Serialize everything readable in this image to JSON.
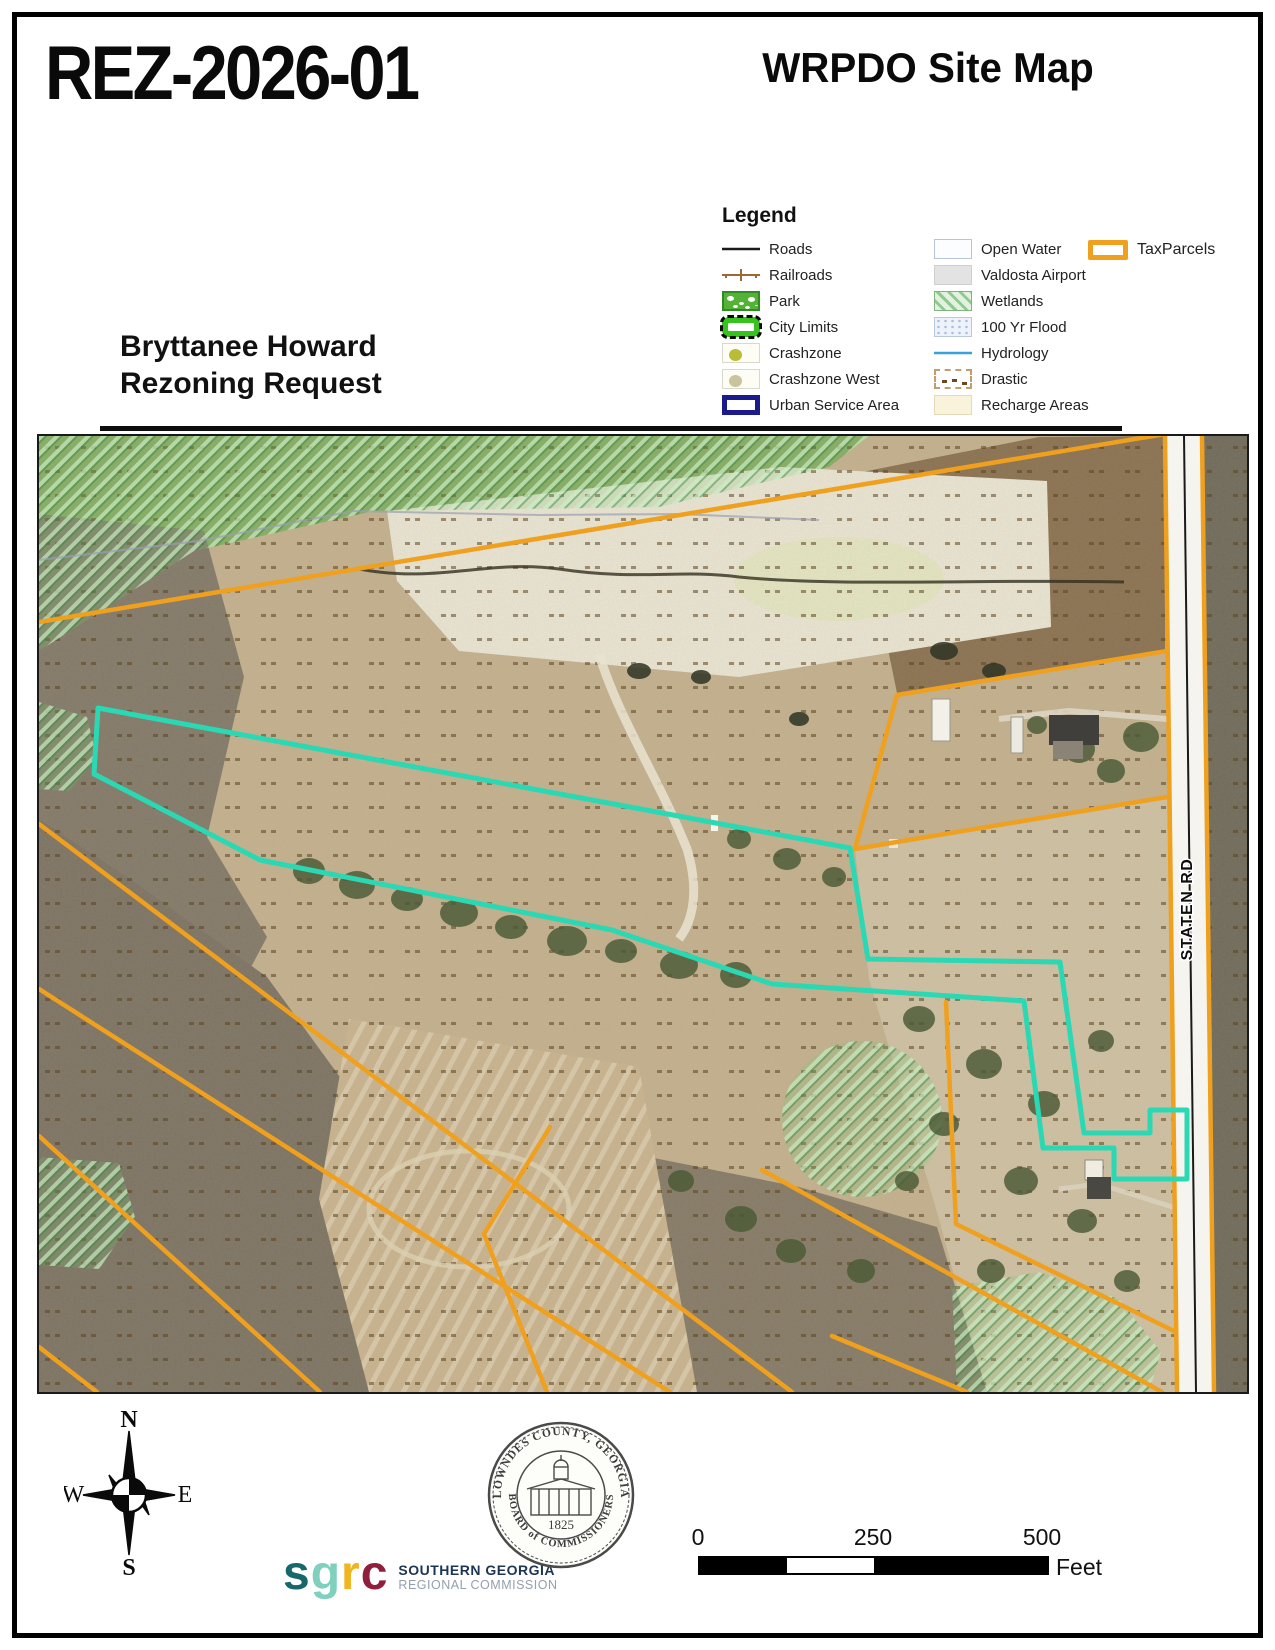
{
  "header": {
    "case_number": "REZ-2026-01",
    "map_title": "WRPDO Site Map"
  },
  "request_label": {
    "line1": "Bryttanee Howard",
    "line2": "Rezoning Request"
  },
  "legend": {
    "title": "Legend",
    "col1": [
      {
        "label": "Roads",
        "swatch": "roads-line"
      },
      {
        "label": "Railroads",
        "swatch": "railroad-line"
      },
      {
        "label": "Park",
        "swatch": "park-fill"
      },
      {
        "label": "City Limits",
        "swatch": "city-limits-fill"
      },
      {
        "label": "Crashzone",
        "swatch": "crashzone-fill"
      },
      {
        "label": "Crashzone West",
        "swatch": "crashzone-west-fill"
      },
      {
        "label": "Urban Service Area",
        "swatch": "urban-service-area-outline"
      }
    ],
    "col2": [
      {
        "label": "Open Water",
        "swatch": "open-water-fill"
      },
      {
        "label": "Valdosta Airport",
        "swatch": "airport-fill"
      },
      {
        "label": "Wetlands",
        "swatch": "wetlands-hatch"
      },
      {
        "label": "100 Yr Flood",
        "swatch": "flood-dots"
      },
      {
        "label": "Hydrology",
        "swatch": "hydrology-line"
      },
      {
        "label": "Drastic",
        "swatch": "drastic-dots"
      },
      {
        "label": "Recharge Areas",
        "swatch": "recharge-fill"
      }
    ],
    "tax_parcels_label": "TaxParcels"
  },
  "map": {
    "road_label": "STATEN RD"
  },
  "compass": {
    "n": "N",
    "s": "S",
    "e": "E",
    "w": "W"
  },
  "scale_bar": {
    "ticks": [
      "0",
      "250",
      "500"
    ],
    "unit": "Feet"
  },
  "footer": {
    "sgrc": {
      "l1": "s",
      "l2": "g",
      "l3": "r",
      "l4": "c",
      "org_line1": "SOUTHERN GEORGIA",
      "org_line2": "REGIONAL COMMISSION"
    },
    "seal": {
      "arc_top": "LOWNDES COUNTY, GEORGIA",
      "arc_bottom": "BOARD of COMMISSIONERS",
      "year": "1825"
    }
  },
  "colors": {
    "tax_parcel_line": "#EFA01F",
    "subject_parcel_line": "#2BD8B4",
    "urban_service_area": "#1b1b8e",
    "hydrology_line": "#3aa0dc",
    "city_limits_green": "#35c41b"
  }
}
